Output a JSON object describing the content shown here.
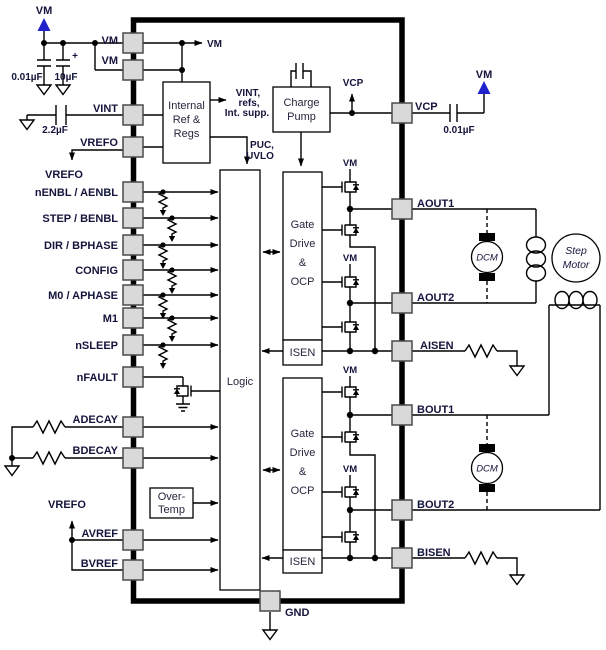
{
  "colors": {
    "vm_arrow": "#2222cc",
    "pin_fill": "#d9d9d9",
    "wire": "#000000",
    "text": "#14143c"
  },
  "nets": {
    "vm": "VM",
    "vcp": "VCP",
    "vrefo": "VREFO"
  },
  "annotations": {
    "int_ref_out": [
      "VINT,",
      "refs,",
      "Int. supp."
    ],
    "puc_uvlo": [
      "PUC,",
      "UVLO"
    ]
  },
  "components": {
    "cap_vm_small": "0.01µF",
    "cap_vm_bulk": "10µF",
    "cap_vint": "2.2µF",
    "cap_vcp": "0.01µF",
    "plus_sign": "+",
    "motor_dcm": "DCM",
    "motor_step": [
      "Step",
      "Motor"
    ]
  },
  "blocks": {
    "internal_ref": [
      "Internal",
      "Ref &",
      "Regs"
    ],
    "charge_pump": [
      "Charge",
      "Pump"
    ],
    "logic": "Logic",
    "gate_drive": [
      "Gate",
      "Drive",
      "&",
      "OCP"
    ],
    "isen": "ISEN",
    "over_temp": [
      "Over-",
      "Temp"
    ]
  },
  "pins": {
    "left": [
      "VM",
      "VM",
      "VINT",
      "VREFO",
      "nENBL / AENBL",
      "STEP / BENBL",
      "DIR / BPHASE",
      "CONFIG",
      "M0 / APHASE",
      "M1",
      "nSLEEP",
      "nFAULT",
      "ADECAY",
      "BDECAY",
      "AVREF",
      "BVREF"
    ],
    "right": [
      "VCP",
      "AOUT1",
      "AOUT2",
      "AISEN",
      "BOUT1",
      "BOUT2",
      "BISEN"
    ],
    "bottom": [
      "GND"
    ]
  }
}
